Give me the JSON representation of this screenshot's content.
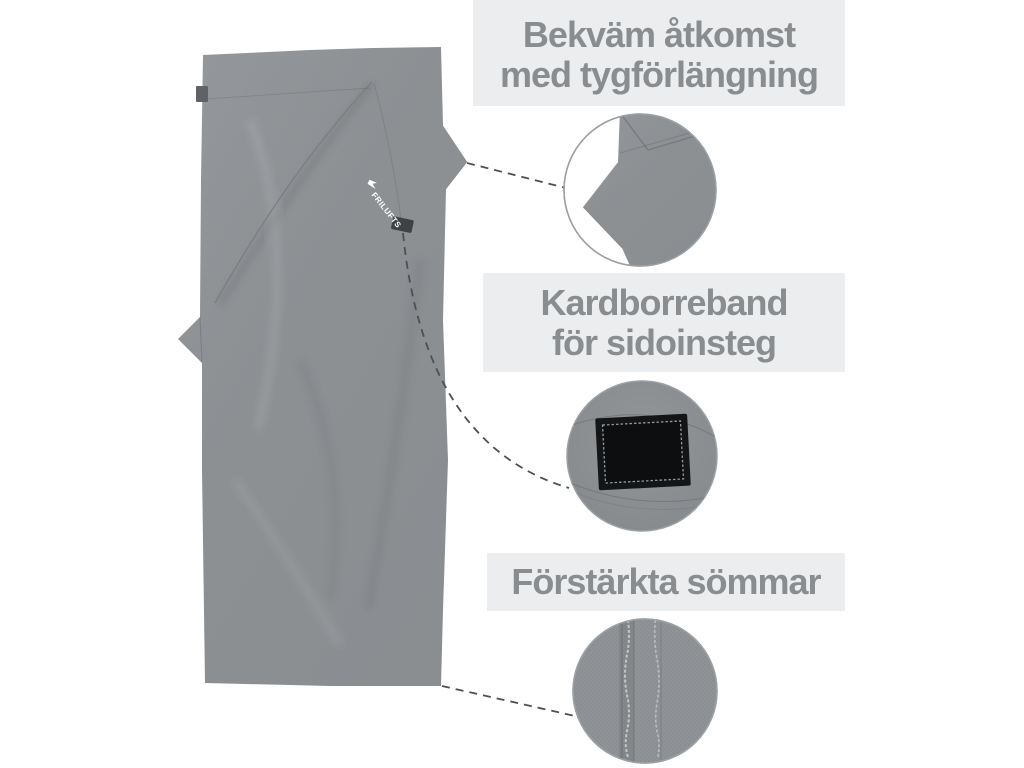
{
  "page": {
    "background_color": "#ffffff",
    "description": "product feature callout image of a gray sleeping-bag liner / travel sheet"
  },
  "product": {
    "type": "travel-sheet-liner",
    "logo_text": "FRILUFTS",
    "fabric_color": "#8b8f92",
    "fabric_highlight": "#94989c",
    "tag_color": "#5f6367",
    "velcro_tab_color": "#3f4245",
    "velcro_patch_color": "#141516"
  },
  "annotations": [
    {
      "id": "fabric-extension",
      "lines": [
        "Bekväm åtkomst",
        "med tygförlängning"
      ],
      "detail": "fabric-extension-closeup"
    },
    {
      "id": "velcro-side-entry",
      "lines": [
        "Kardborreband",
        "för sidoinsteg"
      ],
      "detail": "velcro-patch-closeup"
    },
    {
      "id": "reinforced-seams",
      "lines": [
        "Förstärkta sömmar"
      ],
      "detail": "stitched-seams-closeup"
    }
  ],
  "styles": {
    "label_text_color": "#898d90",
    "label_bg_color": "#ebedee",
    "connector_color": "#4c5053",
    "circle_border_color": "#9aa0a4"
  }
}
